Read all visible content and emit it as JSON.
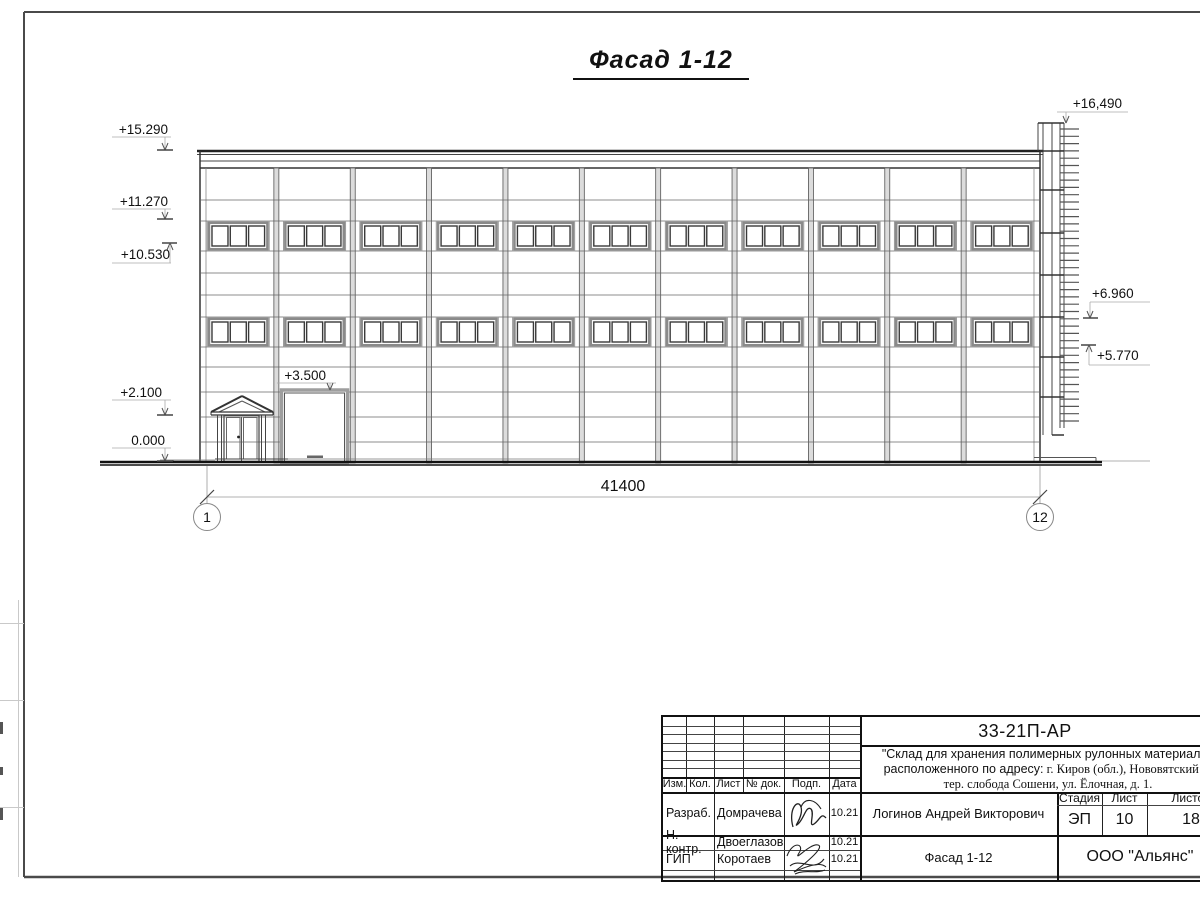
{
  "sheet": {
    "view_title": "Фасад 1-12",
    "dimension_total": "41400",
    "axis_left": "1",
    "axis_right": "12"
  },
  "elevation_marks": {
    "left": [
      "+15.290",
      "+11.270",
      "+10.530",
      "+2.100",
      "0.000"
    ],
    "gate": "+3.500",
    "right": [
      "+16,490",
      "+6.960",
      "+5.770"
    ]
  },
  "drawing": {
    "bays": 11,
    "window_rows": 2,
    "window_panes": 3
  },
  "title_block": {
    "doc_number": "33-21П-АР",
    "project_line1": "\"Склад для хранения полимерных рулонных материалов",
    "project_line2_sans": "расположенного по адресу:",
    "project_line2_serif": " г. Киров (обл.), Нововятский р-",
    "project_line3": "тер. слобода Сошени, ул. Ёлочная, д. 1.",
    "header_cells": [
      "Изм.",
      "Кол.",
      "Лист",
      "№ док.",
      "Подп.",
      "Дата"
    ],
    "stage_header": [
      "Стадия",
      "Лист",
      "Листов"
    ],
    "stage_values": [
      "ЭП",
      "10",
      "18"
    ],
    "chief_name": "Логинов Андрей Викторович",
    "drawing_title": "Фасад 1-12",
    "company": "ООО \"Альянс\"",
    "roles": [
      {
        "role": "Разраб.",
        "name": "Домрачева",
        "date": "10.21"
      },
      {
        "role": "Н. контр.",
        "name": "Двоеглазов",
        "date": "10.21"
      },
      {
        "role": "ГИП",
        "name": "Коротаев",
        "date": "10.21"
      }
    ]
  }
}
